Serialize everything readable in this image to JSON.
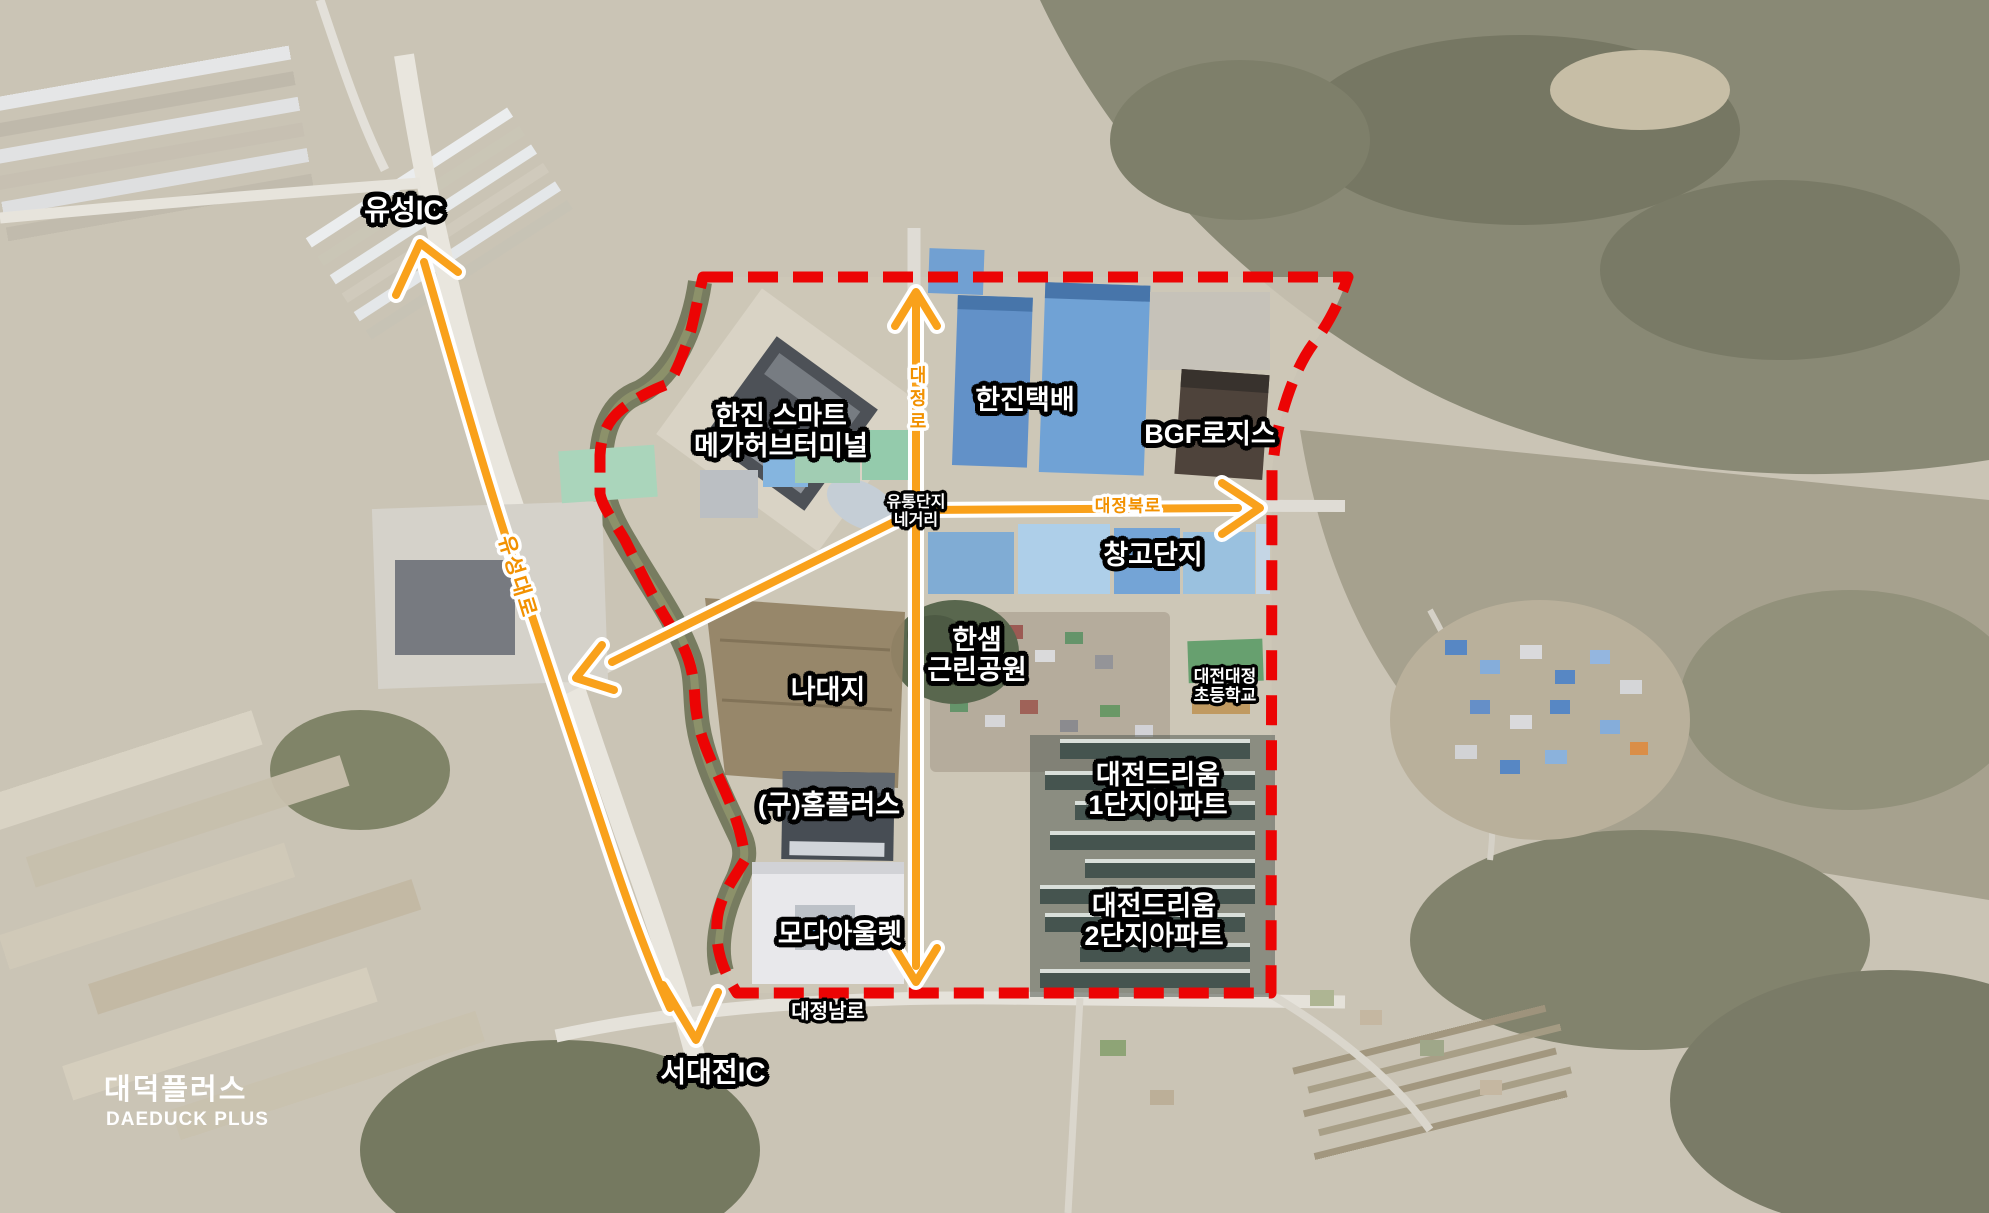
{
  "canvas": {
    "width": 1989,
    "height": 1213
  },
  "colors": {
    "boundary_red": "#ec0404",
    "arrow_orange": "#f9a11b",
    "road_label_orange": "#f29100",
    "label_text": "#ffffff",
    "label_outline": "#000000"
  },
  "labels": {
    "yuseong_ic": "유성IC",
    "seodaejeon_ic": "서대전IC",
    "hanjin_terminal": {
      "line1": "한진 스마트",
      "line2": "메가허브터미널"
    },
    "hanjin_parcel": "한진택배",
    "bgf_logis": "BGF로지스",
    "warehouse_complex": "창고단지",
    "hansaem_park": {
      "line1": "한샘",
      "line2": "근린공원"
    },
    "daejeon_daejeong_elementary": {
      "line1": "대전대정",
      "line2": "초등학교"
    },
    "vacant_land": "나대지",
    "former_homeplus": "(구)홈플러스",
    "dreamium1": {
      "line1": "대전드리움",
      "line2": "1단지아파트"
    },
    "dreamium2": {
      "line1": "대전드리움",
      "line2": "2단지아파트"
    },
    "moda_outlet": "모다아울렛",
    "distribution_intersection": {
      "line1": "유통단지",
      "line2": "네거리"
    }
  },
  "roads": {
    "yuseong_daero": "유성대로",
    "daejeong_ro": "대정로",
    "daejeong_bukro": "대정북로",
    "daejeong_namro": "대정남로"
  },
  "logo": {
    "korean": "대덕플러스",
    "english": "DAEDUCK PLUS"
  }
}
